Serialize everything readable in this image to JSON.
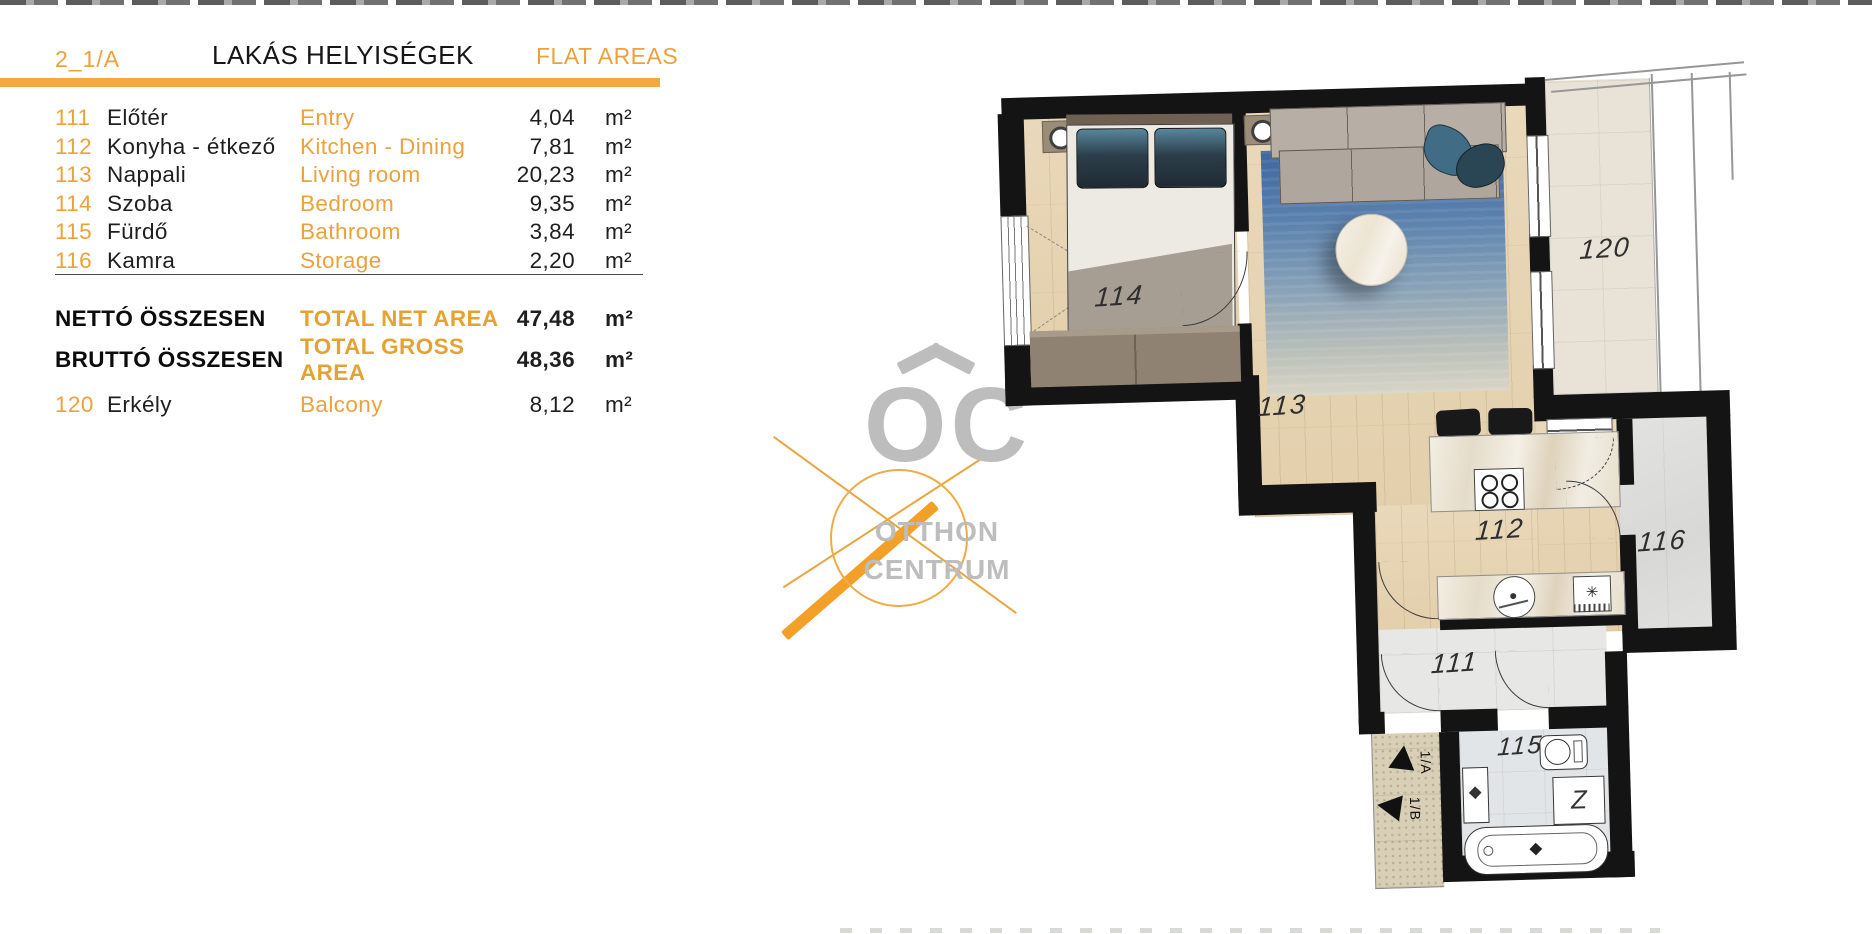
{
  "header": {
    "unit_id": "2_1/A",
    "title_hu": "LAKÁS HELYISÉGEK",
    "title_en": "FLAT AREAS"
  },
  "rooms": [
    {
      "code": "111",
      "name_hu": "Előtér",
      "name_en": "Entry",
      "area": "4,04",
      "unit": "m²"
    },
    {
      "code": "112",
      "name_hu": "Konyha - étkező",
      "name_en": "Kitchen - Dining",
      "area": "7,81",
      "unit": "m²"
    },
    {
      "code": "113",
      "name_hu": "Nappali",
      "name_en": "Living room",
      "area": "20,23",
      "unit": "m²"
    },
    {
      "code": "114",
      "name_hu": "Szoba",
      "name_en": "Bedroom",
      "area": "9,35",
      "unit": "m²"
    },
    {
      "code": "115",
      "name_hu": "Fürdő",
      "name_en": "Bathroom",
      "area": "3,84",
      "unit": "m²"
    },
    {
      "code": "116",
      "name_hu": "Kamra",
      "name_en": "Storage",
      "area": "2,20",
      "unit": "m²"
    }
  ],
  "totals": {
    "net_label_hu": "NETTÓ ÖSSZESEN",
    "net_label_en": "TOTAL NET AREA",
    "net_value": "47,48",
    "gross_label_hu": "BRUTTÓ ÖSSZESEN",
    "gross_label_en": "TOTAL GROSS AREA",
    "gross_value": "48,36",
    "unit": "m²"
  },
  "balcony_row": {
    "code": "120",
    "name_hu": "Erkély",
    "name_en": "Balcony",
    "area": "8,12",
    "unit": "m²"
  },
  "logo": {
    "monogram": "OC",
    "line1": "OTTHON",
    "line2": "CENTRUM"
  },
  "plan": {
    "labels": {
      "r111": "111",
      "r112": "112",
      "r113": "113",
      "r114": "114",
      "r115": "115",
      "r116": "116",
      "r120": "120"
    },
    "arrows": {
      "a": "1/A",
      "b": "1/B"
    },
    "washer_glyph": "Z",
    "appliance_glyph": "✳"
  },
  "colors": {
    "accent_text": "#EBA23C",
    "accent_bar": "#F4A93B",
    "text_dark": "#1A1A1A",
    "logo_gray": "#BDBDBD",
    "wall_black": "#141414",
    "rug_blue": "#3C66A0"
  }
}
